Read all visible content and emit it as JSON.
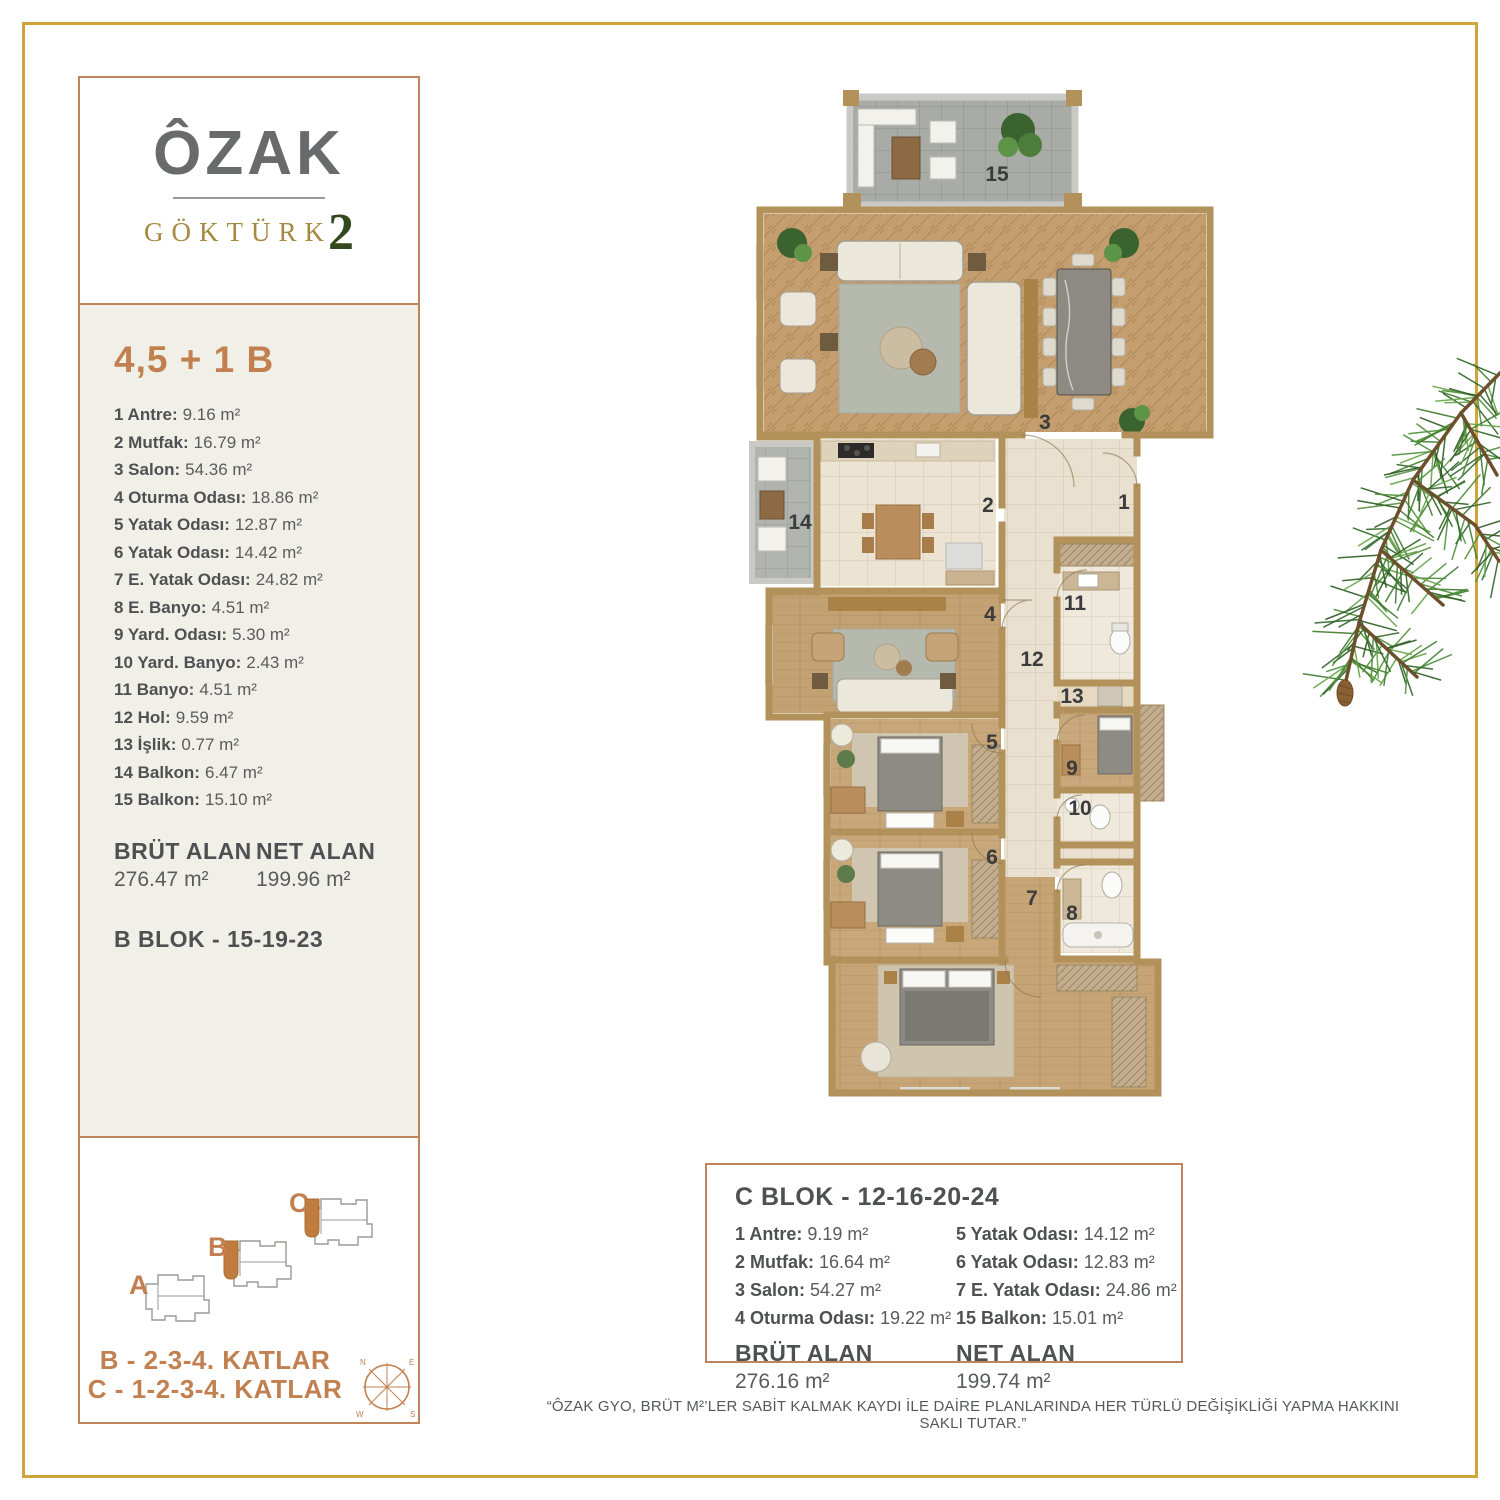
{
  "logo": {
    "name": "ÔZAK",
    "sub": "GÖKTÜRK",
    "sub_number": "2"
  },
  "unit": {
    "title": "4,5 + 1 B",
    "rooms": [
      {
        "label": "1 Antre:",
        "value": "9.16 m²"
      },
      {
        "label": "2 Mutfak:",
        "value": "16.79 m²"
      },
      {
        "label": "3 Salon:",
        "value": "54.36 m²"
      },
      {
        "label": "4 Oturma Odası:",
        "value": "18.86 m²"
      },
      {
        "label": "5 Yatak Odası:",
        "value": "12.87 m²"
      },
      {
        "label": "6 Yatak Odası:",
        "value": "14.42 m²"
      },
      {
        "label": "7 E. Yatak Odası:",
        "value": "24.82 m²"
      },
      {
        "label": "8 E. Banyo:",
        "value": "4.51 m²"
      },
      {
        "label": "9 Yard. Odası:",
        "value": "5.30 m²"
      },
      {
        "label": "10 Yard. Banyo:",
        "value": "2.43 m²"
      },
      {
        "label": "11 Banyo:",
        "value": "4.51 m²"
      },
      {
        "label": "12 Hol:",
        "value": "9.59 m²"
      },
      {
        "label": "13 İşlik:",
        "value": "0.77 m²"
      },
      {
        "label": "14 Balkon:",
        "value": "6.47 m²"
      },
      {
        "label": "15 Balkon:",
        "value": "15.10 m²"
      }
    ],
    "brut_label": "BRÜT ALAN",
    "brut_value": "276.47 m²",
    "net_label": "NET ALAN",
    "net_value": "199.96 m²",
    "block_line": "B BLOK - 15-19-23"
  },
  "siteplan": {
    "labels": {
      "a": "A",
      "b": "B",
      "c": "C"
    },
    "floors_b": "B - 2-3-4. KATLAR",
    "floors_c": "C - 1-2-3-4. KATLAR",
    "compass": {
      "n": "N",
      "e": "E",
      "s": "S",
      "w": "W"
    }
  },
  "plan": {
    "numbers": [
      "1",
      "2",
      "3",
      "4",
      "5",
      "6",
      "7",
      "8",
      "9",
      "10",
      "11",
      "12",
      "13",
      "14",
      "15"
    ]
  },
  "cblok": {
    "title": "C BLOK - 12-16-20-24",
    "left": [
      {
        "label": "1 Antre:",
        "value": "9.19 m²"
      },
      {
        "label": "2 Mutfak:",
        "value": "16.64 m²"
      },
      {
        "label": "3 Salon:",
        "value": "54.27 m²"
      },
      {
        "label": "4 Oturma Odası:",
        "value": "19.22 m²"
      }
    ],
    "right": [
      {
        "label": "5 Yatak Odası:",
        "value": "14.12 m²"
      },
      {
        "label": "6 Yatak Odası:",
        "value": "12.83 m²"
      },
      {
        "label": "7 E. Yatak Odası:",
        "value": "24.86 m²"
      },
      {
        "label": "15 Balkon:",
        "value": "15.01 m²"
      }
    ],
    "brut_label": "BRÜT ALAN",
    "brut_value": "276.16 m²",
    "net_label": "NET ALAN",
    "net_value": "199.74 m²"
  },
  "disclaimer": "“ÔZAK GYO, BRÜT M²’LER SABİT KALMAK KAYDI İLE DAİRE PLANLARINDA HER TÜRLÜ DEĞİŞİKLİĞİ YAPMA HAKKINI SAKLI TUTAR.”"
}
